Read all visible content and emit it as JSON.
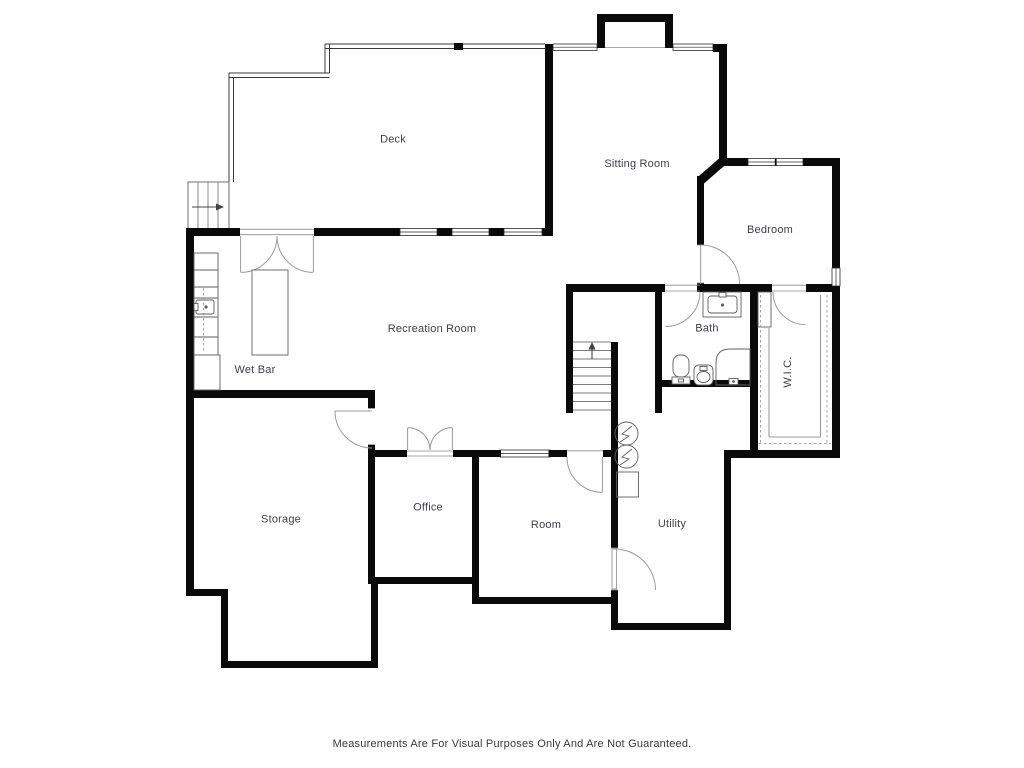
{
  "page": {
    "background": "#ffffff"
  },
  "colors": {
    "wall": "#0a0a0a",
    "railing": "#3a3a3a",
    "furniture_line": "#5f5f5f",
    "door_arc": "#9a9a9a",
    "label": "#3f3f46"
  },
  "rooms": {
    "deck": {
      "label": "Deck"
    },
    "sitting_room": {
      "label": "Sitting Room"
    },
    "bedroom": {
      "label": "Bedroom"
    },
    "recreation_room": {
      "label": "Recreation Room"
    },
    "wet_bar": {
      "label": "Wet Bar"
    },
    "bath": {
      "label": "Bath"
    },
    "wic": {
      "label": "W.I.C."
    },
    "storage": {
      "label": "Storage"
    },
    "office": {
      "label": "Office"
    },
    "room": {
      "label": "Room"
    },
    "utility": {
      "label": "Utility"
    }
  },
  "footer": {
    "disclaimer": "Measurements Are For Visual Purposes Only And Are Not Guaranteed."
  }
}
